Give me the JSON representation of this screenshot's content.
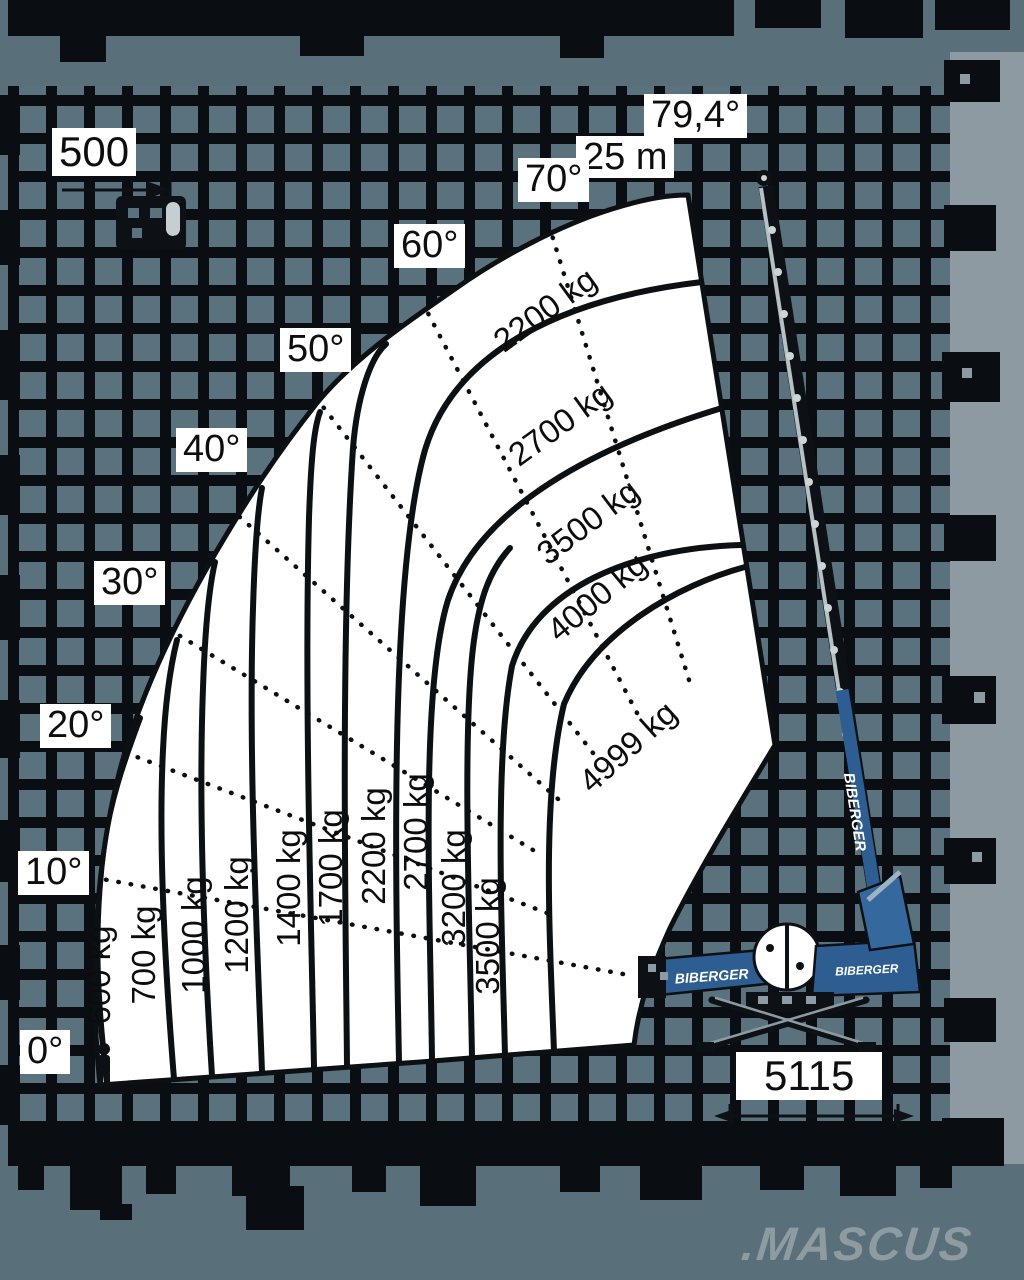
{
  "meta": {
    "brand": "BIBERGER",
    "watermark": ".MASCUS"
  },
  "chart_data": {
    "type": "crane-load-diagram",
    "title": "Telescopic crane load capacity diagram",
    "boom_angles_deg": [
      0,
      10,
      20,
      30,
      40,
      50,
      60,
      70,
      79.4
    ],
    "max_boom_length_label": "25 m",
    "jib_capacity_label": "500",
    "support_base_label": "5115",
    "radial_zone_capacities_kg": [
      600,
      700,
      1000,
      1200,
      1400,
      1700,
      2200,
      2700,
      3200,
      3500
    ],
    "arc_zone_capacities_kg": [
      2200,
      2700,
      3500,
      4000,
      4999
    ],
    "min_capacity_kg": 600,
    "max_capacity_kg": 4999,
    "legend_position": "none",
    "grid": true
  },
  "labels": {
    "angles": [
      "0°",
      "10°",
      "20°",
      "30°",
      "40°",
      "50°",
      "60°",
      "70°",
      "79,4°"
    ],
    "reach": "25 m",
    "jib_capacity": "500",
    "base_width": "5115",
    "radial_capacities": [
      "600 kg",
      "700 kg",
      "1000 kg",
      "1200 kg",
      "1400 kg",
      "1700 kg",
      "2200 kg",
      "2700 kg",
      "3200 kg",
      "3500 kg"
    ],
    "arc_capacities": [
      "2200 kg",
      "2700 kg",
      "3500 kg",
      "4000 kg",
      "4999 kg"
    ]
  },
  "crane": {
    "brand_boom": "BIBERGER",
    "brand_jib": "BIBERGER",
    "brand_body": "BIBERGER"
  },
  "colors": {
    "background": "#59707a",
    "grid_line": "#0a0e13",
    "fan_fill": "#ffffff",
    "crane_blue": "#2e5d91",
    "side_strip": "#8d9aa1",
    "watermark": "#8e9ba1"
  }
}
